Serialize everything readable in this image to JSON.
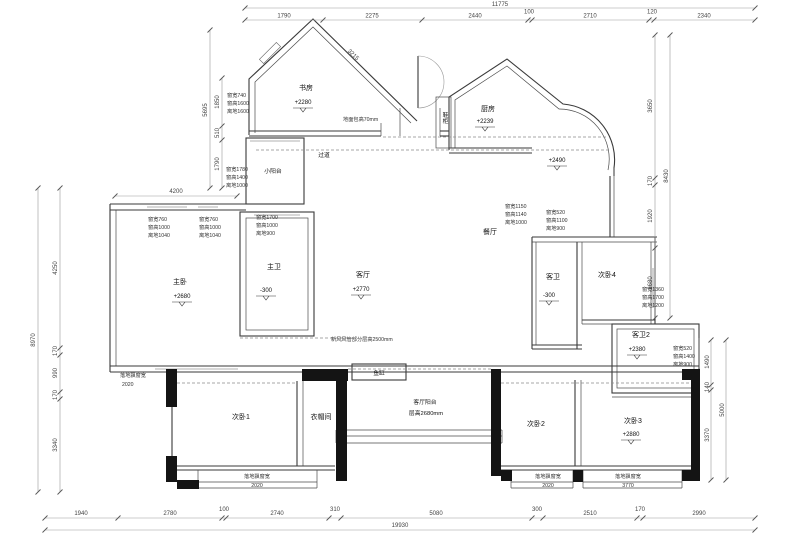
{
  "drawing": {
    "rooms": {
      "study": {
        "name": "书房",
        "level": "+2280"
      },
      "kitchen": {
        "name": "厨房",
        "level": "+2239"
      },
      "kitchen_balcony": {
        "level": "+2490"
      },
      "entry_corridor": {
        "name": "过道"
      },
      "small_balcony": {
        "name": "小阳台"
      },
      "shoe_cabinet": {
        "name": "鞋柜"
      },
      "master_bedroom": {
        "name": "主卧",
        "level": "+2680"
      },
      "master_bath": {
        "name": "主卫",
        "level": "-300"
      },
      "living": {
        "name": "客厅",
        "level": "+2770"
      },
      "dining": {
        "name": "餐厅"
      },
      "guest_bath": {
        "name": "客卫",
        "level": "-300"
      },
      "bedroom4": {
        "name": "次卧4"
      },
      "guest_bath2": {
        "name": "客卫2",
        "level": "+2380"
      },
      "bedroom1": {
        "name": "次卧1"
      },
      "closet": {
        "name": "衣帽间"
      },
      "bedroom2": {
        "name": "次卧2"
      },
      "bedroom3": {
        "name": "次卧3",
        "level": "+2880"
      },
      "fish_tank": {
        "name": "鱼缸"
      },
      "living_balcony": {
        "name": "客厅阳台",
        "height_note": "层高2680mm"
      }
    },
    "notes": {
      "floor_raise": "地面包高70mm",
      "ceiling_zone": "新风风管部分层高2500mm"
    },
    "window_tags": {
      "study_left": [
        "窗宽740",
        "窗高1600",
        "离地1600"
      ],
      "small_balcony_tag": [
        "窗宽1780",
        "窗高1400",
        "离地1000"
      ],
      "master_win1": [
        "窗宽760",
        "窗高1000",
        "离地1040"
      ],
      "master_win2": [
        "窗宽760",
        "窗高1000",
        "离地1040"
      ],
      "master_bath_win": [
        "窗宽1700",
        "窗高1000",
        "离地900"
      ],
      "dining_win": [
        "窗宽1150",
        "窗高1140",
        "离地1000"
      ],
      "guest_bath_win": [
        "窗宽520",
        "窗高1100",
        "离地900"
      ],
      "bedroom4_win": [
        "窗宽1360",
        "窗高1700",
        "离地1200"
      ],
      "guest_bath2_win": [
        "窗宽520",
        "窗高1400",
        "离地900"
      ]
    },
    "bay_windows": {
      "master": {
        "label": "落地飘窗宽",
        "value": "2020"
      },
      "bedroom1": {
        "label": "落地飘窗宽",
        "value": "2020"
      },
      "bedroom2": {
        "label": "落地飘窗宽",
        "value": "2020"
      },
      "bedroom3": {
        "label": "落地飘窗宽",
        "value": "3770"
      }
    },
    "dims": {
      "top_total": "11775",
      "top": [
        "1790",
        "2275",
        "2440",
        "100",
        "2710",
        "120",
        "2340"
      ],
      "diag_study": "3215",
      "bottom": [
        "1940",
        "2780",
        "100",
        "2740",
        "310",
        "5080",
        "300",
        "2510",
        "170",
        "2990"
      ],
      "bottom_total": "19930",
      "left_outer_total": "8970",
      "left": [
        "4250",
        "170",
        "990",
        "170",
        "3340"
      ],
      "left_upper_total": "5695",
      "left_upper": [
        "1850",
        "510",
        "1790"
      ],
      "master_width": "4200",
      "right_upper_total": "8430",
      "right_upper": [
        "3650",
        "170",
        "1920",
        "2680"
      ],
      "right_lower_total": "5000",
      "right_lower": [
        "1490",
        "140",
        "3370"
      ]
    }
  }
}
